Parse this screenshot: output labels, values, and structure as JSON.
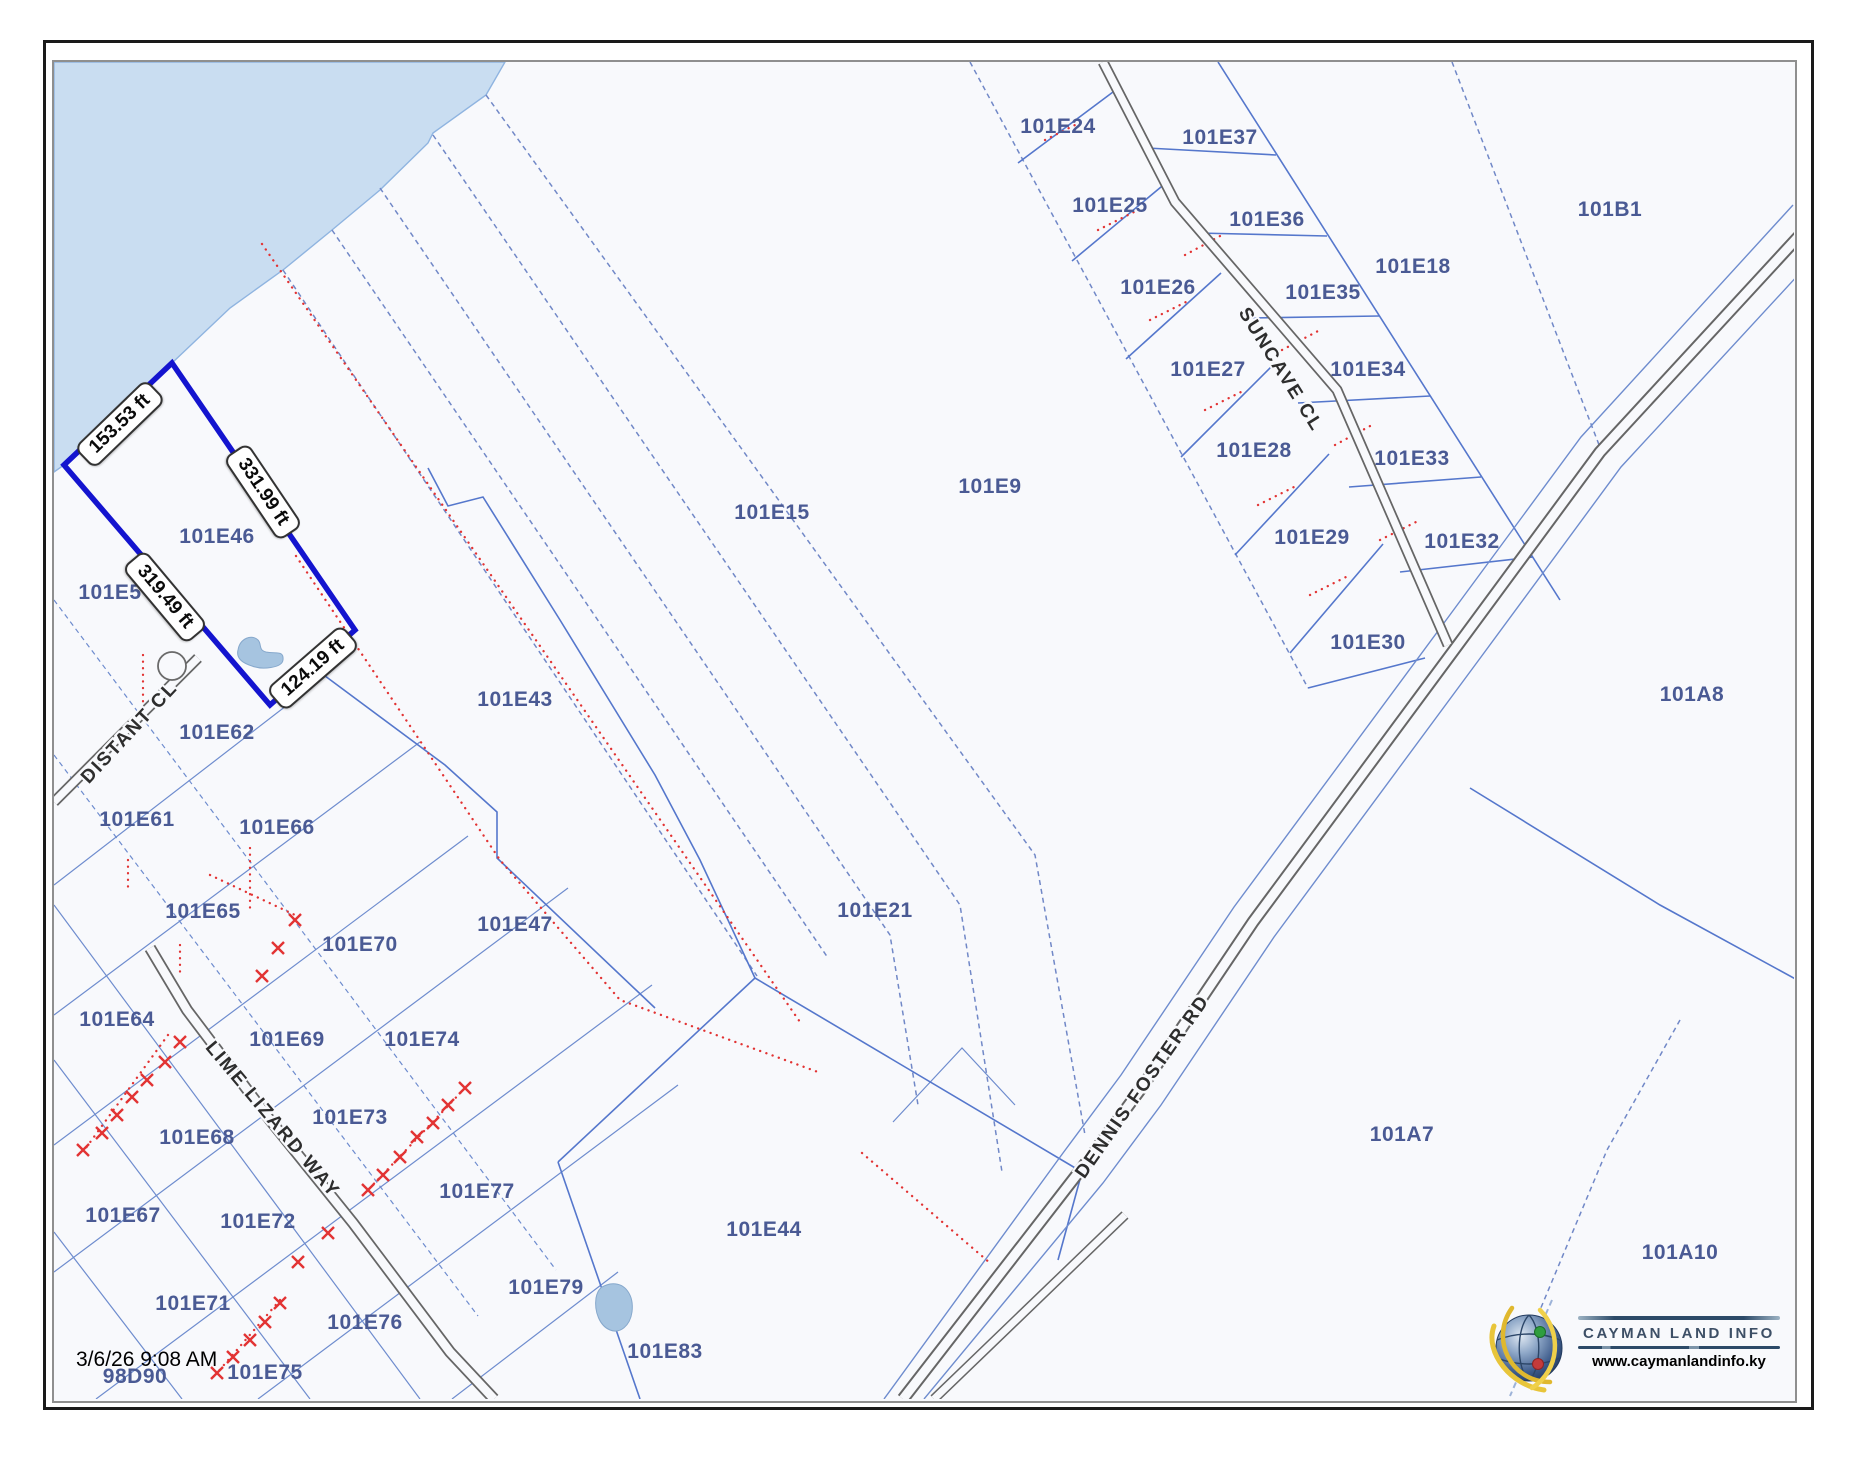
{
  "map": {
    "timestamp": "3/6/26 9:08 AM",
    "parcel_labels": [
      {
        "id": "101E24",
        "x": 1058,
        "y": 127
      },
      {
        "id": "101E37",
        "x": 1220,
        "y": 138
      },
      {
        "id": "101E25",
        "x": 1110,
        "y": 206
      },
      {
        "id": "101E36",
        "x": 1267,
        "y": 220
      },
      {
        "id": "101E18",
        "x": 1413,
        "y": 267
      },
      {
        "id": "101E26",
        "x": 1158,
        "y": 288
      },
      {
        "id": "101E35",
        "x": 1323,
        "y": 293
      },
      {
        "id": "101E27",
        "x": 1208,
        "y": 370
      },
      {
        "id": "101E34",
        "x": 1368,
        "y": 370
      },
      {
        "id": "101E28",
        "x": 1254,
        "y": 451
      },
      {
        "id": "101E33",
        "x": 1412,
        "y": 459
      },
      {
        "id": "101E29",
        "x": 1312,
        "y": 538
      },
      {
        "id": "101E32",
        "x": 1462,
        "y": 542
      },
      {
        "id": "101E30",
        "x": 1368,
        "y": 643
      },
      {
        "id": "101B1",
        "x": 1610,
        "y": 210
      },
      {
        "id": "101E9",
        "x": 990,
        "y": 487
      },
      {
        "id": "101E15",
        "x": 772,
        "y": 513
      },
      {
        "id": "101E46",
        "x": 217,
        "y": 537
      },
      {
        "id": "101E5",
        "x": 110,
        "y": 593
      },
      {
        "id": "101E62",
        "x": 217,
        "y": 733
      },
      {
        "id": "101E43",
        "x": 515,
        "y": 700
      },
      {
        "id": "101E61",
        "x": 137,
        "y": 820
      },
      {
        "id": "101E66",
        "x": 277,
        "y": 828
      },
      {
        "id": "101E65",
        "x": 203,
        "y": 912
      },
      {
        "id": "101E70",
        "x": 360,
        "y": 945
      },
      {
        "id": "101E47",
        "x": 515,
        "y": 925
      },
      {
        "id": "101E21",
        "x": 875,
        "y": 911
      },
      {
        "id": "101E64",
        "x": 117,
        "y": 1020
      },
      {
        "id": "101E69",
        "x": 287,
        "y": 1040
      },
      {
        "id": "101E74",
        "x": 422,
        "y": 1040
      },
      {
        "id": "101E73",
        "x": 350,
        "y": 1118
      },
      {
        "id": "101E68",
        "x": 197,
        "y": 1138
      },
      {
        "id": "101E77",
        "x": 477,
        "y": 1192
      },
      {
        "id": "101E67",
        "x": 123,
        "y": 1216
      },
      {
        "id": "101E72",
        "x": 258,
        "y": 1222
      },
      {
        "id": "101E44",
        "x": 764,
        "y": 1230
      },
      {
        "id": "101E71",
        "x": 193,
        "y": 1304
      },
      {
        "id": "101E76",
        "x": 365,
        "y": 1323
      },
      {
        "id": "101E79",
        "x": 546,
        "y": 1288
      },
      {
        "id": "101E83",
        "x": 665,
        "y": 1352
      },
      {
        "id": "101E75",
        "x": 265,
        "y": 1373
      },
      {
        "id": "98D90",
        "x": 135,
        "y": 1377
      },
      {
        "id": "101A8",
        "x": 1692,
        "y": 695
      },
      {
        "id": "101A7",
        "x": 1402,
        "y": 1135
      },
      {
        "id": "101A10",
        "x": 1680,
        "y": 1253
      }
    ],
    "dimension_labels": [
      {
        "text": "153.53 ft",
        "x": 120,
        "y": 424,
        "rot": -44
      },
      {
        "text": "331.99 ft",
        "x": 263,
        "y": 492,
        "rot": 56
      },
      {
        "text": "319.49 ft",
        "x": 165,
        "y": 597,
        "rot": 50
      },
      {
        "text": "124.19 ft",
        "x": 313,
        "y": 668,
        "rot": -41
      }
    ],
    "road_labels": [
      {
        "text": "DISTANT CL",
        "x": 130,
        "y": 733,
        "rot": -47
      },
      {
        "text": "LIME LIZARD WAY",
        "x": 272,
        "y": 1120,
        "rot": 50
      },
      {
        "text": "SUNCAVE CL",
        "x": 1280,
        "y": 370,
        "rot": 58
      },
      {
        "text": "DENNIS FOSTER RD",
        "x": 1143,
        "y": 1087,
        "rot": -55
      }
    ],
    "colors": {
      "water": "#c9ddf1",
      "parcel_line": "#5577cc",
      "parcel_label": "#4a5a94",
      "highlight": "#1414cf",
      "red_feature": "#e23333",
      "road_edge": "#666666",
      "logo_navy": "#2c4a68"
    }
  },
  "branding": {
    "title": "CAYMAN LAND INFO",
    "url": "www.caymanlandinfo.ky"
  }
}
